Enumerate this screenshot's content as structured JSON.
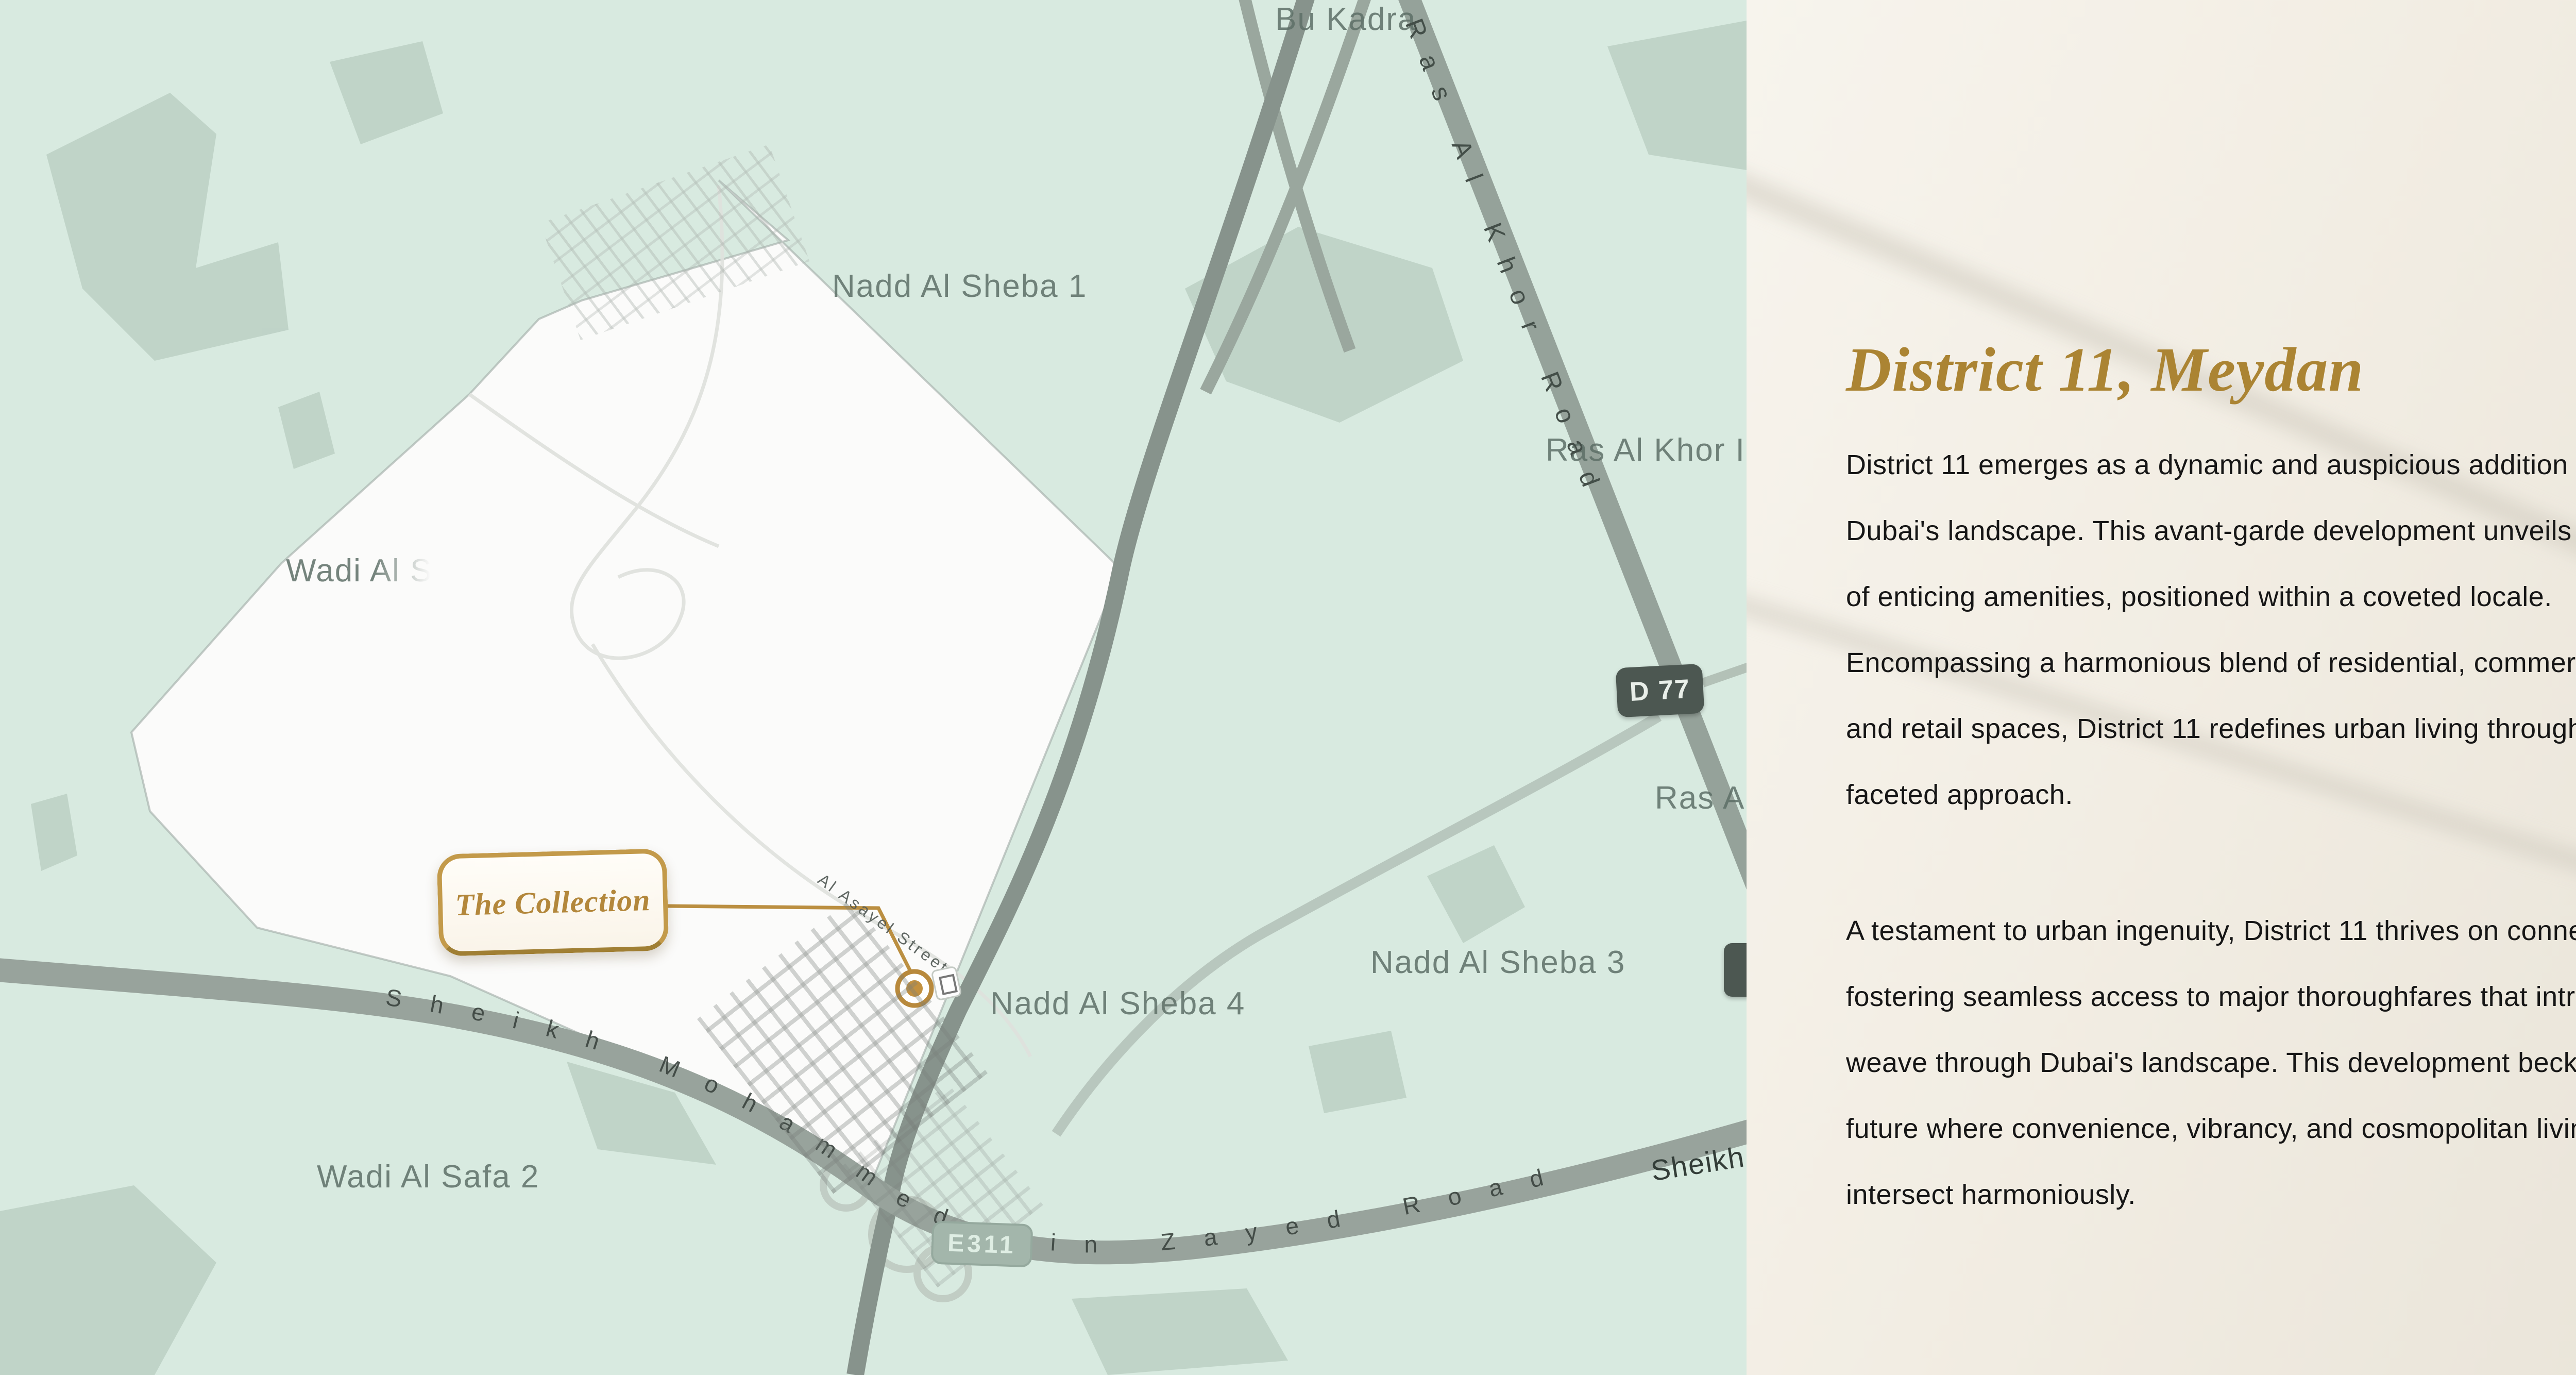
{
  "map": {
    "area_labels": {
      "bu_kadra": "Bu Kadra",
      "nadd_al_sheba_1": "Nadd Al Sheba 1",
      "ras_al_khor_in": "Ras Al Khor In",
      "wadi_al_s": "Wadi Al S",
      "ras_a": "Ras A",
      "nadd_al_sheba_3": "Nadd Al Sheba 3",
      "nadd_al_sheba_4": "Nadd Al Sheba 4",
      "wadi_al_safa_2": "Wadi Al Safa 2",
      "sheikh_partial": "Sheikh"
    },
    "road_labels": {
      "ras_al_khor_road": "Ras Al Khor Road",
      "sheikh_mohammed_bin_zayed_road": "Sheikh Mohammed Bin Zayed Road",
      "al_asayel_street": "Al Asayel Street"
    },
    "badges": {
      "d77": "D 77",
      "e311": "E311"
    },
    "marker": {
      "label": "The Collection"
    },
    "colors": {
      "map_bg": "#d8eae0",
      "site_polygon": "#fbfbfa",
      "road": "#8e9b93",
      "gold": "#b8893c"
    }
  },
  "panel": {
    "title": "District 11, Meydan",
    "paragraph1": "District 11 emerges as a dynamic and auspicious addition to\nDubai's landscape. This avant-garde development unveils an array\nof enticing amenities, positioned within a coveted locale.\nEncompassing a harmonious blend of residential, commercial,\nand retail spaces, District 11 redefines urban living through its multi-\nfaceted approach.",
    "paragraph2": "A testament to urban ingenuity, District 11 thrives on connectivity,\nfostering seamless access to major thoroughfares that intricately\nweave through Dubai's landscape. This development beckons a\nfuture where convenience, vibrancy, and cosmopolitan living\nintersect harmoniously.",
    "colors": {
      "title_gold": "#ab8433",
      "panel_bg": "#f2ede3"
    }
  }
}
